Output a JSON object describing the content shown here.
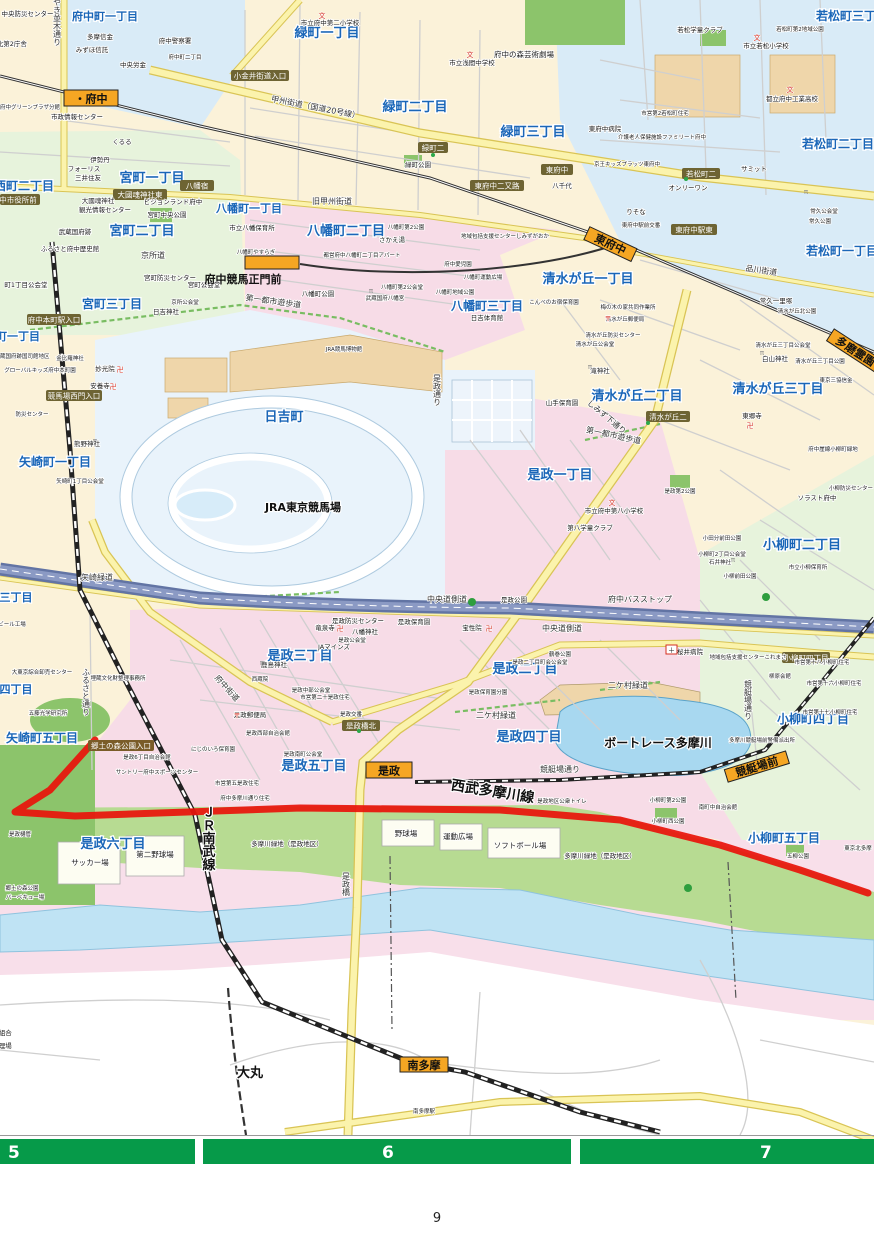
{
  "page_number": "9",
  "index_bar": {
    "cells": [
      "5",
      "6",
      "7"
    ],
    "color": "#069A49"
  },
  "stations": {
    "fuchu": "・府中",
    "seimonmae": "府中競馬正門前",
    "higashifuchu": "東府中",
    "tamareien": "多磨霊園",
    "koremasa": "是政",
    "kyoteijomae": "競艇場前",
    "minamitama": "南多摩"
  },
  "areas": {
    "fuchucho1": "府中町一丁目",
    "fuchucho2": "府中町二丁目",
    "midoricho1": "緑町一丁目",
    "midoricho2": "緑町二丁目",
    "midoricho3": "緑町三丁目",
    "wakamatsu1": "若松町一丁目",
    "wakamatsu2": "若松町二丁目",
    "wakamatsu3": "若松町三丁目",
    "shimizu1": "清水が丘一丁目",
    "shimizu2": "清水が丘二丁目",
    "shimizu3": "清水が丘三丁目",
    "nishimachi2": "西町二丁目",
    "miyamachi1": "宮町一丁目",
    "miyamachi2": "宮町二丁目",
    "miyamachi3": "宮町三丁目",
    "hachiman1": "八幡町一丁目",
    "hachiman2": "八幡町二丁目",
    "hachiman3": "八幡町三丁目",
    "honmachi1": "町一丁目",
    "yazaki1": "矢崎町一丁目",
    "yazaki3": "三丁目",
    "yazaki4": "四丁目",
    "yazaki5": "矢崎町五丁目",
    "hiyoshicho": "日吉町",
    "koremasa1": "是政一丁目",
    "koremasa2": "是政二丁目",
    "koremasa3": "是政三丁目",
    "koremasa4": "是政四丁目",
    "koremasa5": "是政五丁目",
    "koremasa6": "是政六丁目",
    "koyanagi2": "小柳町二丁目",
    "koyanagi4": "小柳町四丁目",
    "koyanagi5": "小柳町五丁目",
    "omaru": "大丸",
    "boatrace": "ボートレース多摩川",
    "jra": "JRA東京競馬場"
  },
  "roads": {
    "koshu": "甲州街道（国道20号線）",
    "kyukoshu": "旧甲州街道",
    "keyaki": "けやき並木通り",
    "shinagawa": "品川街道",
    "fuchukaido": "府中街道",
    "furusato": "ふるさと通り",
    "koremasadori": "是政通り",
    "chuodosokudo": "中央道側道",
    "yuhodo": "第一都市遊歩道",
    "shimizushita": "しみず下通り",
    "yazakiryokudo": "矢崎緑道",
    "nikemura": "二ケ村緑道",
    "kyoteidori": "競艇場通り",
    "koremasabashi": "是政橋",
    "kyosho": "京所道"
  },
  "railways": {
    "jrnanbu": "ＪＲ南武線",
    "seibu": "西武多摩川線"
  },
  "intersections": {
    "koganei": "小金井街道入口",
    "midori2": "緑町二",
    "higashifuchu": "東府中",
    "yachiyo": "八千代",
    "futamata": "東府中二又路",
    "wakamatsu2": "若松町二",
    "ekihigashi": "東府中駅東",
    "hachimanjuku": "八幡宿",
    "okunitamahigashi": "大國魂神社東",
    "shiyakusho": "中市役所前",
    "honmachieki": "府中本町駅入口",
    "nishimon": "競馬場西門入口",
    "shimizu2": "清水が丘二",
    "kyodoiriguchi": "郷土の森公園入口",
    "koremasabashikita": "是政橋北",
    "koyanagi4": "小柳町四丁目"
  },
  "facilities": {
    "shobo": "府中消防署・中央防災センター",
    "ekikita": "府中駅北第2庁舎",
    "tamashin": "多摩信金",
    "mizuho": "みずほ信託",
    "rokin": "中央労金",
    "keisatsu": "府中警察署",
    "joho": "市政情報センター",
    "greenplaza": "府中グリーンプラザ分館",
    "kururu": "くるる",
    "isetan": "伊勢丹",
    "foris": "フォーリス",
    "mitsui": "三井住友",
    "okunitama": "大國魂神社",
    "kanko": "観光情報センター",
    "pigeon": "ビジョンランド府中",
    "miyamachipark": "宮町中央公園",
    "kokufuato": "武蔵国府跡",
    "rekishikan": "ふるさと府中歴史館",
    "miyabosai": "宮町防災センター",
    "miyakokaido": "宮町公会堂",
    "cho1kokaido": "町1丁目公会堂",
    "fuchu2sho": "市立府中第二小学校",
    "geijutsu": "府中の森芸術劇場",
    "sengen": "市立浅間中学校",
    "midoripark": "緑町公園",
    "sakaeyu": "さかえ湯",
    "toeiapart": "都営府中八幡町二丁目アパート",
    "hachimanpark": "八幡町公園",
    "hachimangu": "武蔵国府八幡宮",
    "hachiman2kokai": "八幡町第2公会堂",
    "aijien": "府中愛児園",
    "chiikipark": "八幡町地域公園",
    "hachiman2park": "八幡町第2公園",
    "undohiroba8": "八幡町運動広場",
    "yasuragi": "八幡町やすらぎ",
    "hachimanhoiku": "市立八幡保育所",
    "hiyoshitaiiku": "日吉体育館",
    "konbe": "こんべのお宿保育園",
    "umenoki": "梅の木の家共同作業所",
    "shimizuyubin": "清水が丘郵便局",
    "shimizubosai": "清水が丘防災センター",
    "shimizukokai": "清水が丘公会堂",
    "takijinja": "滝神社",
    "yamatehoiku": "山手保育園",
    "hakusan": "白山神社",
    "togoji": "東郷寺",
    "tsunehisa": "常久一里塚",
    "shimizukita": "清水が丘北公園",
    "shimizu3kokai": "清水が丘三丁目公会堂",
    "shimizu3park": "清水が丘三丁目公園",
    "sankyo": "東京三協信金",
    "gaisen": "府中崖線小柳町緑地",
    "sorasuto": "ソラスト府中",
    "koyanagibosai": "小柳防災センター",
    "fuchu8sho": "市立府中第八小学校",
    "dai8gakudo": "第八学童クラブ",
    "koremasa2park": "是政第2公園",
    "odawake": "小田分前田公園",
    "koyanagi2kokai": "小柳町2丁目公会堂",
    "ishii": "石井神社",
    "koyanagimaeda": "小柳前田公園",
    "koyanagihoiku": "市立小柳保育所",
    "sakurai": "桜井病院",
    "koremasacenter": "地域包括支援センターこれまさ",
    "shiei18": "市営第十八小柳町住宅",
    "yanagihara": "柳原会館",
    "shiei16": "市営第十六小柳町住宅",
    "shiei17": "市営第十七小柳町住宅",
    "hoshoin": "宝性院",
    "koremasapark": "是政公園",
    "tsurumaki": "鶴巻公園",
    "koremasa2cho": "是政二丁目町会公会堂",
    "koremasahoiku": "是政保育園",
    "koremasahoikubun": "是政保育園分園",
    "koremasabosai": "是政防災センター",
    "ryusenji": "竜泉寺",
    "hachimanjinja": "八幡神社",
    "koremasakokai": "是政公会堂",
    "jamines": "JAマインズ",
    "kashima": "鹿島神社",
    "saizoin": "西蔵院",
    "chubukokai": "是政中部公会堂",
    "shiei20": "市営第二十是政住宅",
    "koremasayubin": "是政郵便局",
    "koremasakoban": "是政交番",
    "seibujichi": "是政西部自治会館",
    "nijinoiro": "にじのいろ保育園",
    "nancho": "是政南町公会堂",
    "shiei5": "市営第五是政住宅",
    "tamagawadori": "府中多摩川通り住宅",
    "suntory": "サントリー府中スポーツセンター",
    "koremasa6jichi": "是政6丁目自治会館",
    "kumano": "熊野神社",
    "yazaki1kokai": "矢崎町1丁目公会堂",
    "anyoji": "安養寺",
    "myokoin": "妙光院",
    "konpira": "金比羅神社",
    "globalkids": "グローバルキッズ府中本町園",
    "kokushikan": "武蔵国府跡国司館地区",
    "oroshiuri": "大東京綜合卸売センター",
    "beer": "ビール工場",
    "goto": "五藤光学研究所",
    "maizo": "埋蔵文化財整理事務所",
    "kyodonomori": "郷土の森公園",
    "bbq": "バーベキュー場",
    "hikan": "是政樋管",
    "soccer": "サッカー場",
    "yakyu2": "第二野球場",
    "yakyu": "野球場",
    "undohiroba": "運動広場",
    "softball": "ソフトボール場",
    "ryokuchi1": "多摩川緑地（是政地区）",
    "ryokuchi2": "多摩川緑地（是政地区）",
    "toilet": "是政地区公衆トイレ",
    "koyanagi2park": "小柳町第2公園",
    "minamimachijichi": "南町中自治会館",
    "koyanaginishi": "小柳町西公園",
    "goryu": "五柳公園",
    "keiteikoban": "多摩川競艇場前警備派出所",
    "hfuchubyoin": "東府中病院",
    "shiei2wakamatsu": "市営第2若松町住宅",
    "wakamatsugakudo": "若松学童クラブ",
    "wakamatsusho": "市立若松小学校",
    "kogyokoko": "都立府中工業高校",
    "tsunehisakokai": "常久公会堂",
    "tsunehisapark": "常久公園",
    "summit": "サミット",
    "onlyone": "オンリーワン",
    "risona": "りそな",
    "ekimaekoban": "東府中駅前交番",
    "kidsplats": "京王キッズプラッツ東府中",
    "family": "介護老人保健施設ファミリート府中",
    "wakamatsu2chiiki": "若松町第2地域公園",
    "shimizugaoka": "地域包括支援センターしみずがおか",
    "minamitamaeki": "南多摩駅",
    "hiyoshijinja": "日吉神社",
    "kyoshokokai": "京所公会堂",
    "bosaicenter": "防災センター",
    "seisokai": "生組合",
    "shorijo": "処理場",
    "tokyokita": "東京北多摩",
    "jramuseum": "JRA競馬博物館",
    "busstop": "府中バスストップ"
  },
  "icons": {
    "school": "文",
    "temple": "卍",
    "post": "〒",
    "torii": "π",
    "hospital": "＋"
  },
  "colors": {
    "area_pink": "#F7DCE7",
    "area_cream": "#FBF2D9",
    "area_blue": "#D9EBF7",
    "area_green": "#E7F3DC",
    "park_green": "#8CC46B",
    "bank_green": "#B7DB92",
    "water": "#BFE3F4",
    "road_yellow": "#FBF3AC",
    "expressway": "#6274A4",
    "route_red": "#E8140C",
    "station_orange": "#F5A623",
    "index_green": "#069A49",
    "label_blue": "#1A66B8"
  }
}
